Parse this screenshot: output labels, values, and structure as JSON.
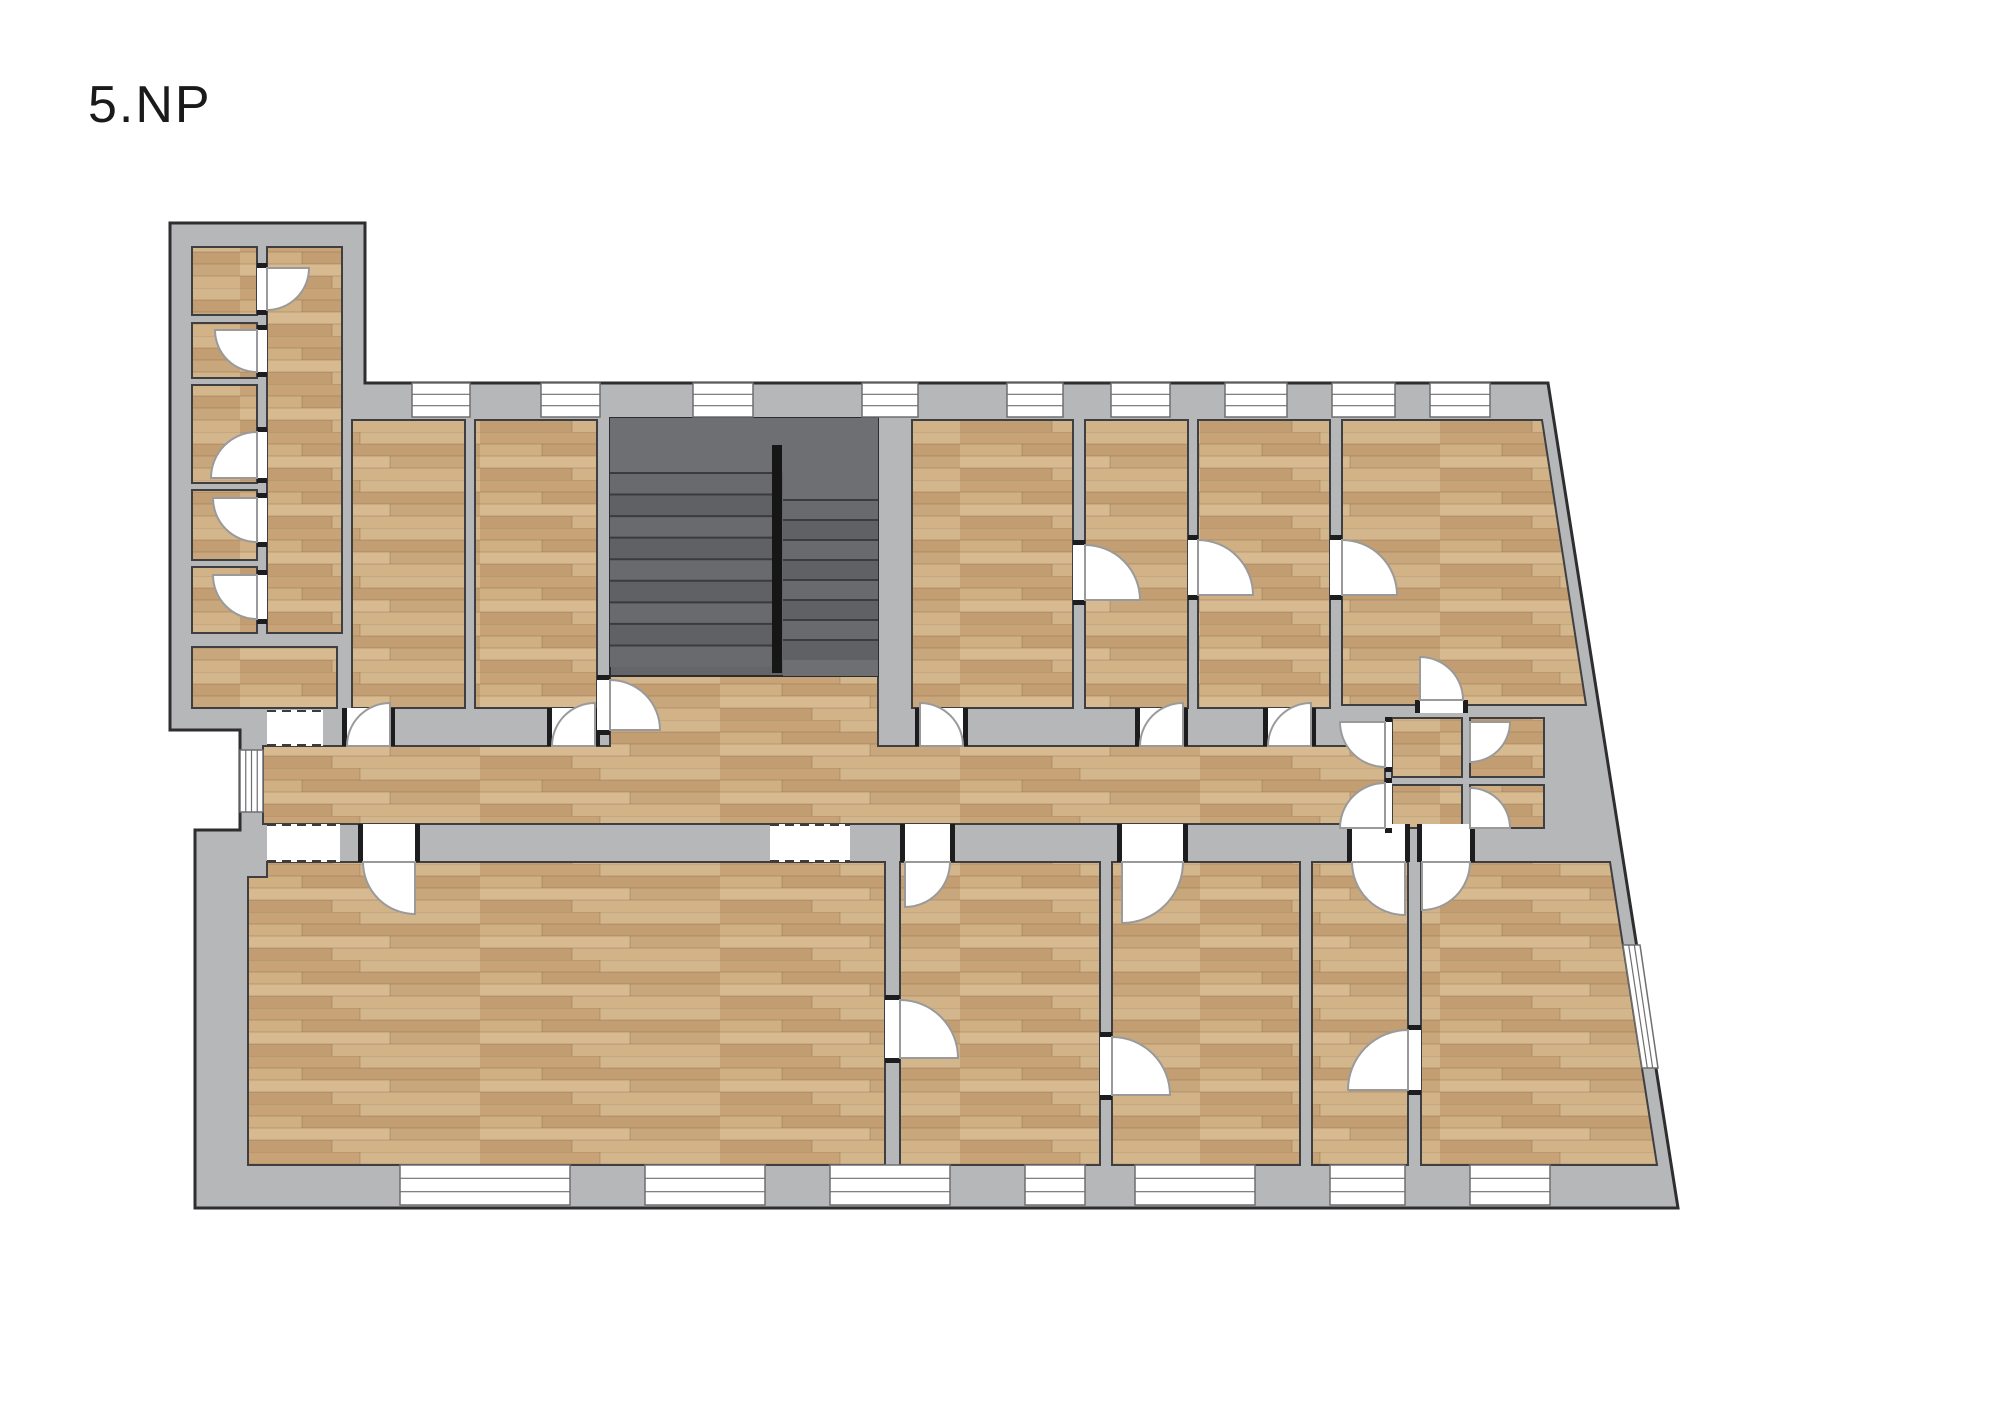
{
  "title": "5.NP",
  "canvas": {
    "width": 2000,
    "height": 1414
  },
  "colors": {
    "background": "#ffffff",
    "wall_fill": "#b6b7b9",
    "wall_outline": "#2e2e30",
    "room_outline": "#3f3f41",
    "stair_base": "#636568",
    "stair_landing": "#6d6f72",
    "stair_step_a": "#5f6164",
    "stair_step_b": "#686a6d",
    "stair_step_dark": "#3b3b3d",
    "railing": "#161616",
    "door_stroke": "#9a9a9a",
    "window_stroke": "#6f6f71",
    "jamb": "#1d1d1f",
    "dash_stroke": "#3c3c3e",
    "title_color": "#1a1a1a"
  },
  "floorplan": {
    "outline": [
      [
        170,
        223
      ],
      [
        365,
        223
      ],
      [
        365,
        383
      ],
      [
        1548,
        383
      ],
      [
        1678,
        1208
      ],
      [
        195,
        1208
      ],
      [
        195,
        830
      ],
      [
        240,
        830
      ],
      [
        240,
        730
      ],
      [
        170,
        730
      ]
    ],
    "wood_pattern": {
      "tile": [
        240,
        48
      ],
      "base": "#cdab80",
      "planks": [
        [
          0,
          0,
          120,
          12,
          "#c7a377"
        ],
        [
          120,
          0,
          120,
          12,
          "#d4b68c"
        ],
        [
          0,
          12,
          62,
          12,
          "#d0b082"
        ],
        [
          62,
          12,
          178,
          12,
          "#c39e73"
        ],
        [
          0,
          24,
          150,
          12,
          "#d7ba90"
        ],
        [
          150,
          24,
          90,
          12,
          "#c9a77c"
        ],
        [
          0,
          36,
          92,
          12,
          "#c29d72"
        ],
        [
          92,
          36,
          148,
          12,
          "#d2b287"
        ]
      ],
      "seam": "rgba(115,85,58,0.3)"
    },
    "rooms": [
      {
        "name": "wing-room-1",
        "rect": [
          192,
          247,
          65,
          68
        ]
      },
      {
        "name": "wing-room-2",
        "rect": [
          192,
          323,
          65,
          55
        ]
      },
      {
        "name": "wing-room-3",
        "rect": [
          192,
          385,
          65,
          98
        ]
      },
      {
        "name": "wing-room-4",
        "rect": [
          192,
          490,
          65,
          70
        ]
      },
      {
        "name": "wing-room-5",
        "rect": [
          192,
          567,
          65,
          66
        ]
      },
      {
        "name": "wing-hall",
        "rect": [
          267,
          247,
          75,
          386
        ]
      },
      {
        "name": "wing-room-6",
        "rect": [
          192,
          647,
          145,
          61
        ]
      },
      {
        "name": "room-a",
        "rect": [
          352,
          420,
          113,
          288
        ]
      },
      {
        "name": "room-b",
        "rect": [
          475,
          420,
          122,
          288
        ]
      },
      {
        "name": "room-c",
        "rect": [
          912,
          420,
          161,
          288
        ]
      },
      {
        "name": "room-d",
        "rect": [
          1085,
          420,
          103,
          288
        ]
      },
      {
        "name": "room-e",
        "rect": [
          1198,
          420,
          132,
          288
        ]
      },
      {
        "name": "room-f",
        "pts": [
          [
            1342,
            420
          ],
          [
            1542,
            420
          ],
          [
            1586,
            705
          ],
          [
            1342,
            705
          ]
        ]
      },
      {
        "name": "corridor",
        "pts": [
          [
            263,
            746
          ],
          [
            610,
            746
          ],
          [
            610,
            667
          ],
          [
            878,
            667
          ],
          [
            878,
            746
          ],
          [
            1385,
            746
          ],
          [
            1385,
            824
          ],
          [
            263,
            824
          ]
        ]
      },
      {
        "name": "wc-1",
        "rect": [
          1392,
          718,
          70,
          59
        ]
      },
      {
        "name": "wc-2",
        "rect": [
          1470,
          718,
          74,
          59
        ]
      },
      {
        "name": "wc-3",
        "rect": [
          1392,
          785,
          70,
          43
        ]
      },
      {
        "name": "wc-4",
        "rect": [
          1470,
          785,
          74,
          43
        ]
      },
      {
        "name": "room-g",
        "pts": [
          [
            267,
            862
          ],
          [
            885,
            862
          ],
          [
            885,
            1165
          ],
          [
            248,
            1165
          ],
          [
            248,
            877
          ],
          [
            267,
            877
          ]
        ]
      },
      {
        "name": "room-h",
        "rect": [
          900,
          862,
          200,
          303
        ]
      },
      {
        "name": "room-i",
        "rect": [
          1112,
          862,
          188,
          303
        ]
      },
      {
        "name": "room-j",
        "rect": [
          1312,
          862,
          96,
          303
        ]
      },
      {
        "name": "room-k",
        "pts": [
          [
            1421,
            862
          ],
          [
            1610,
            862
          ],
          [
            1657,
            1165
          ],
          [
            1421,
            1165
          ]
        ]
      }
    ],
    "stairs": {
      "block": [
        610,
        418,
        268,
        258
      ],
      "landing": [
        610,
        418,
        268,
        55
      ],
      "fill_plain": [
        [
          783,
          473,
          95,
          27
        ],
        [
          783,
          660,
          95,
          16
        ]
      ],
      "flights": [
        {
          "x": 610,
          "w": 163,
          "y0": 473,
          "y1": 667,
          "steps": 9
        },
        {
          "x": 783,
          "w": 95,
          "y0": 500,
          "y1": 660,
          "steps": 8
        }
      ],
      "railing": [
        772,
        445,
        10,
        228
      ]
    },
    "windows": [
      {
        "name": "window-top-1",
        "rect": [
          412,
          383,
          58,
          34
        ],
        "dir": "h"
      },
      {
        "name": "window-top-2",
        "rect": [
          541,
          383,
          59,
          34
        ],
        "dir": "h"
      },
      {
        "name": "window-top-3",
        "rect": [
          693,
          383,
          60,
          34
        ],
        "dir": "h"
      },
      {
        "name": "window-top-4",
        "rect": [
          862,
          383,
          56,
          34
        ],
        "dir": "h"
      },
      {
        "name": "window-top-5",
        "rect": [
          1007,
          383,
          56,
          34
        ],
        "dir": "h"
      },
      {
        "name": "window-top-6",
        "rect": [
          1111,
          383,
          59,
          34
        ],
        "dir": "h"
      },
      {
        "name": "window-top-7",
        "rect": [
          1225,
          383,
          62,
          34
        ],
        "dir": "h"
      },
      {
        "name": "window-top-8",
        "rect": [
          1332,
          383,
          63,
          34
        ],
        "dir": "h"
      },
      {
        "name": "window-top-9",
        "rect": [
          1430,
          383,
          60,
          34
        ],
        "dir": "h"
      },
      {
        "name": "window-bottom-1",
        "rect": [
          400,
          1165,
          170,
          40
        ],
        "dir": "h"
      },
      {
        "name": "window-bottom-2",
        "rect": [
          645,
          1165,
          120,
          40
        ],
        "dir": "h"
      },
      {
        "name": "window-bottom-3",
        "rect": [
          830,
          1165,
          120,
          40
        ],
        "dir": "h"
      },
      {
        "name": "window-bottom-4",
        "rect": [
          1025,
          1165,
          60,
          40
        ],
        "dir": "h"
      },
      {
        "name": "window-bottom-5",
        "rect": [
          1135,
          1165,
          120,
          40
        ],
        "dir": "h"
      },
      {
        "name": "window-bottom-6",
        "rect": [
          1330,
          1165,
          75,
          40
        ],
        "dir": "h"
      },
      {
        "name": "window-bottom-7",
        "rect": [
          1470,
          1165,
          80,
          40
        ],
        "dir": "h"
      },
      {
        "name": "window-left",
        "rect": [
          240,
          750,
          23,
          62
        ],
        "dir": "v"
      },
      {
        "name": "window-diagonal",
        "pts": [
          [
            1623,
            945
          ],
          [
            1640,
            945
          ],
          [
            1658,
            1068
          ],
          [
            1642,
            1068
          ]
        ],
        "dir": "d"
      }
    ],
    "openings": [
      {
        "name": "doorway-room-a",
        "rect": [
          347,
          708,
          43,
          38
        ]
      },
      {
        "name": "doorway-room-b",
        "rect": [
          552,
          708,
          43,
          38
        ]
      },
      {
        "name": "doorway-room-c",
        "rect": [
          920,
          708,
          43,
          38
        ]
      },
      {
        "name": "doorway-room-d",
        "rect": [
          1140,
          708,
          43,
          38
        ]
      },
      {
        "name": "doorway-room-e",
        "rect": [
          1268,
          708,
          43,
          38
        ]
      },
      {
        "name": "doorway-room-f",
        "rect": [
          1420,
          700,
          43,
          13
        ]
      },
      {
        "name": "doorway-wing-1",
        "rect": [
          257,
          268,
          10,
          42
        ]
      },
      {
        "name": "doorway-wing-2",
        "rect": [
          257,
          330,
          10,
          42
        ]
      },
      {
        "name": "doorway-wing-3",
        "rect": [
          257,
          432,
          10,
          46
        ]
      },
      {
        "name": "doorway-wing-4",
        "rect": [
          257,
          498,
          10,
          44
        ]
      },
      {
        "name": "doorway-wing-5",
        "rect": [
          257,
          575,
          10,
          44
        ]
      },
      {
        "name": "doorway-c-d",
        "rect": [
          1073,
          545,
          12,
          55
        ]
      },
      {
        "name": "doorway-d-e",
        "rect": [
          1188,
          540,
          10,
          55
        ]
      },
      {
        "name": "doorway-e-f",
        "rect": [
          1330,
          540,
          12,
          55
        ]
      },
      {
        "name": "doorway-room-g",
        "rect": [
          363,
          824,
          52,
          38
        ]
      },
      {
        "name": "doorway-room-h",
        "rect": [
          905,
          824,
          45,
          38
        ]
      },
      {
        "name": "doorway-room-i",
        "rect": [
          1122,
          824,
          61,
          38
        ]
      },
      {
        "name": "doorway-room-j",
        "rect": [
          1352,
          824,
          53,
          38
        ]
      },
      {
        "name": "doorway-room-k",
        "rect": [
          1422,
          824,
          48,
          38
        ]
      },
      {
        "name": "doorway-g-h",
        "rect": [
          885,
          1000,
          15,
          58
        ]
      },
      {
        "name": "doorway-h-i",
        "rect": [
          1100,
          1037,
          12,
          58
        ]
      },
      {
        "name": "doorway-j-k",
        "rect": [
          1408,
          1030,
          13,
          60
        ]
      },
      {
        "name": "doorway-wc-1",
        "rect": [
          1385,
          722,
          7,
          45
        ]
      },
      {
        "name": "doorway-wc-3",
        "rect": [
          1385,
          783,
          7,
          45
        ]
      },
      {
        "name": "doorway-stair-hall",
        "rect": [
          597,
          680,
          13,
          50
        ]
      }
    ],
    "doors": [
      {
        "name": "door-room-a",
        "cx": 390,
        "cy": 746,
        "r": 43,
        "a0": 180,
        "a1": 270
      },
      {
        "name": "door-room-b",
        "cx": 595,
        "cy": 746,
        "r": 43,
        "a0": 180,
        "a1": 270
      },
      {
        "name": "door-room-c",
        "cx": 920,
        "cy": 746,
        "r": 43,
        "a0": 270,
        "a1": 360
      },
      {
        "name": "door-room-d",
        "cx": 1183,
        "cy": 746,
        "r": 43,
        "a0": 180,
        "a1": 270
      },
      {
        "name": "door-room-e",
        "cx": 1311,
        "cy": 746,
        "r": 43,
        "a0": 180,
        "a1": 270
      },
      {
        "name": "door-room-f",
        "cx": 1420,
        "cy": 700,
        "r": 43,
        "a0": 270,
        "a1": 360
      },
      {
        "name": "door-wing-1",
        "cx": 267,
        "cy": 268,
        "r": 42,
        "a0": 0,
        "a1": 90
      },
      {
        "name": "door-wing-2",
        "cx": 257,
        "cy": 330,
        "r": 42,
        "a0": 90,
        "a1": 180
      },
      {
        "name": "door-wing-3",
        "cx": 257,
        "cy": 478,
        "r": 46,
        "a0": 180,
        "a1": 270
      },
      {
        "name": "door-wing-4",
        "cx": 257,
        "cy": 498,
        "r": 44,
        "a0": 90,
        "a1": 180
      },
      {
        "name": "door-wing-5",
        "cx": 257,
        "cy": 575,
        "r": 44,
        "a0": 90,
        "a1": 180
      },
      {
        "name": "door-c-d",
        "cx": 1085,
        "cy": 600,
        "r": 55,
        "a0": 270,
        "a1": 360
      },
      {
        "name": "door-d-e",
        "cx": 1198,
        "cy": 595,
        "r": 55,
        "a0": 270,
        "a1": 360
      },
      {
        "name": "door-e-f",
        "cx": 1342,
        "cy": 595,
        "r": 55,
        "a0": 270,
        "a1": 360
      },
      {
        "name": "door-room-g",
        "cx": 415,
        "cy": 862,
        "r": 52,
        "a0": 90,
        "a1": 180
      },
      {
        "name": "door-room-h",
        "cx": 905,
        "cy": 862,
        "r": 45,
        "a0": 0,
        "a1": 90
      },
      {
        "name": "door-room-i",
        "cx": 1122,
        "cy": 862,
        "r": 61,
        "a0": 0,
        "a1": 90
      },
      {
        "name": "door-room-j",
        "cx": 1405,
        "cy": 862,
        "r": 53,
        "a0": 90,
        "a1": 180
      },
      {
        "name": "door-room-k",
        "cx": 1422,
        "cy": 862,
        "r": 48,
        "a0": 0,
        "a1": 90
      },
      {
        "name": "door-g-h",
        "cx": 900,
        "cy": 1058,
        "r": 58,
        "a0": 270,
        "a1": 360
      },
      {
        "name": "door-h-i",
        "cx": 1112,
        "cy": 1095,
        "r": 58,
        "a0": 270,
        "a1": 360
      },
      {
        "name": "door-j-k",
        "cx": 1408,
        "cy": 1090,
        "r": 60,
        "a0": 180,
        "a1": 270
      },
      {
        "name": "door-wc-1",
        "cx": 1385,
        "cy": 722,
        "r": 45,
        "a0": 90,
        "a1": 180
      },
      {
        "name": "door-wc-3",
        "cx": 1385,
        "cy": 828,
        "r": 45,
        "a0": 180,
        "a1": 270
      },
      {
        "name": "door-wc-2",
        "cx": 1470,
        "cy": 722,
        "r": 40,
        "a0": 0,
        "a1": 90
      },
      {
        "name": "door-wc-4",
        "cx": 1470,
        "cy": 828,
        "r": 40,
        "a0": 270,
        "a1": 360
      },
      {
        "name": "door-stair-hall",
        "cx": 610,
        "cy": 730,
        "r": 50,
        "a0": 270,
        "a1": 360
      }
    ],
    "dashed_openings": [
      {
        "name": "opening-vestibule-top",
        "rect": [
          267,
          710,
          56,
          36
        ]
      },
      {
        "name": "opening-vestibule-bottom",
        "rect": [
          267,
          824,
          73,
          38
        ]
      },
      {
        "name": "opening-corridor-g",
        "rect": [
          770,
          824,
          80,
          38
        ]
      }
    ]
  }
}
